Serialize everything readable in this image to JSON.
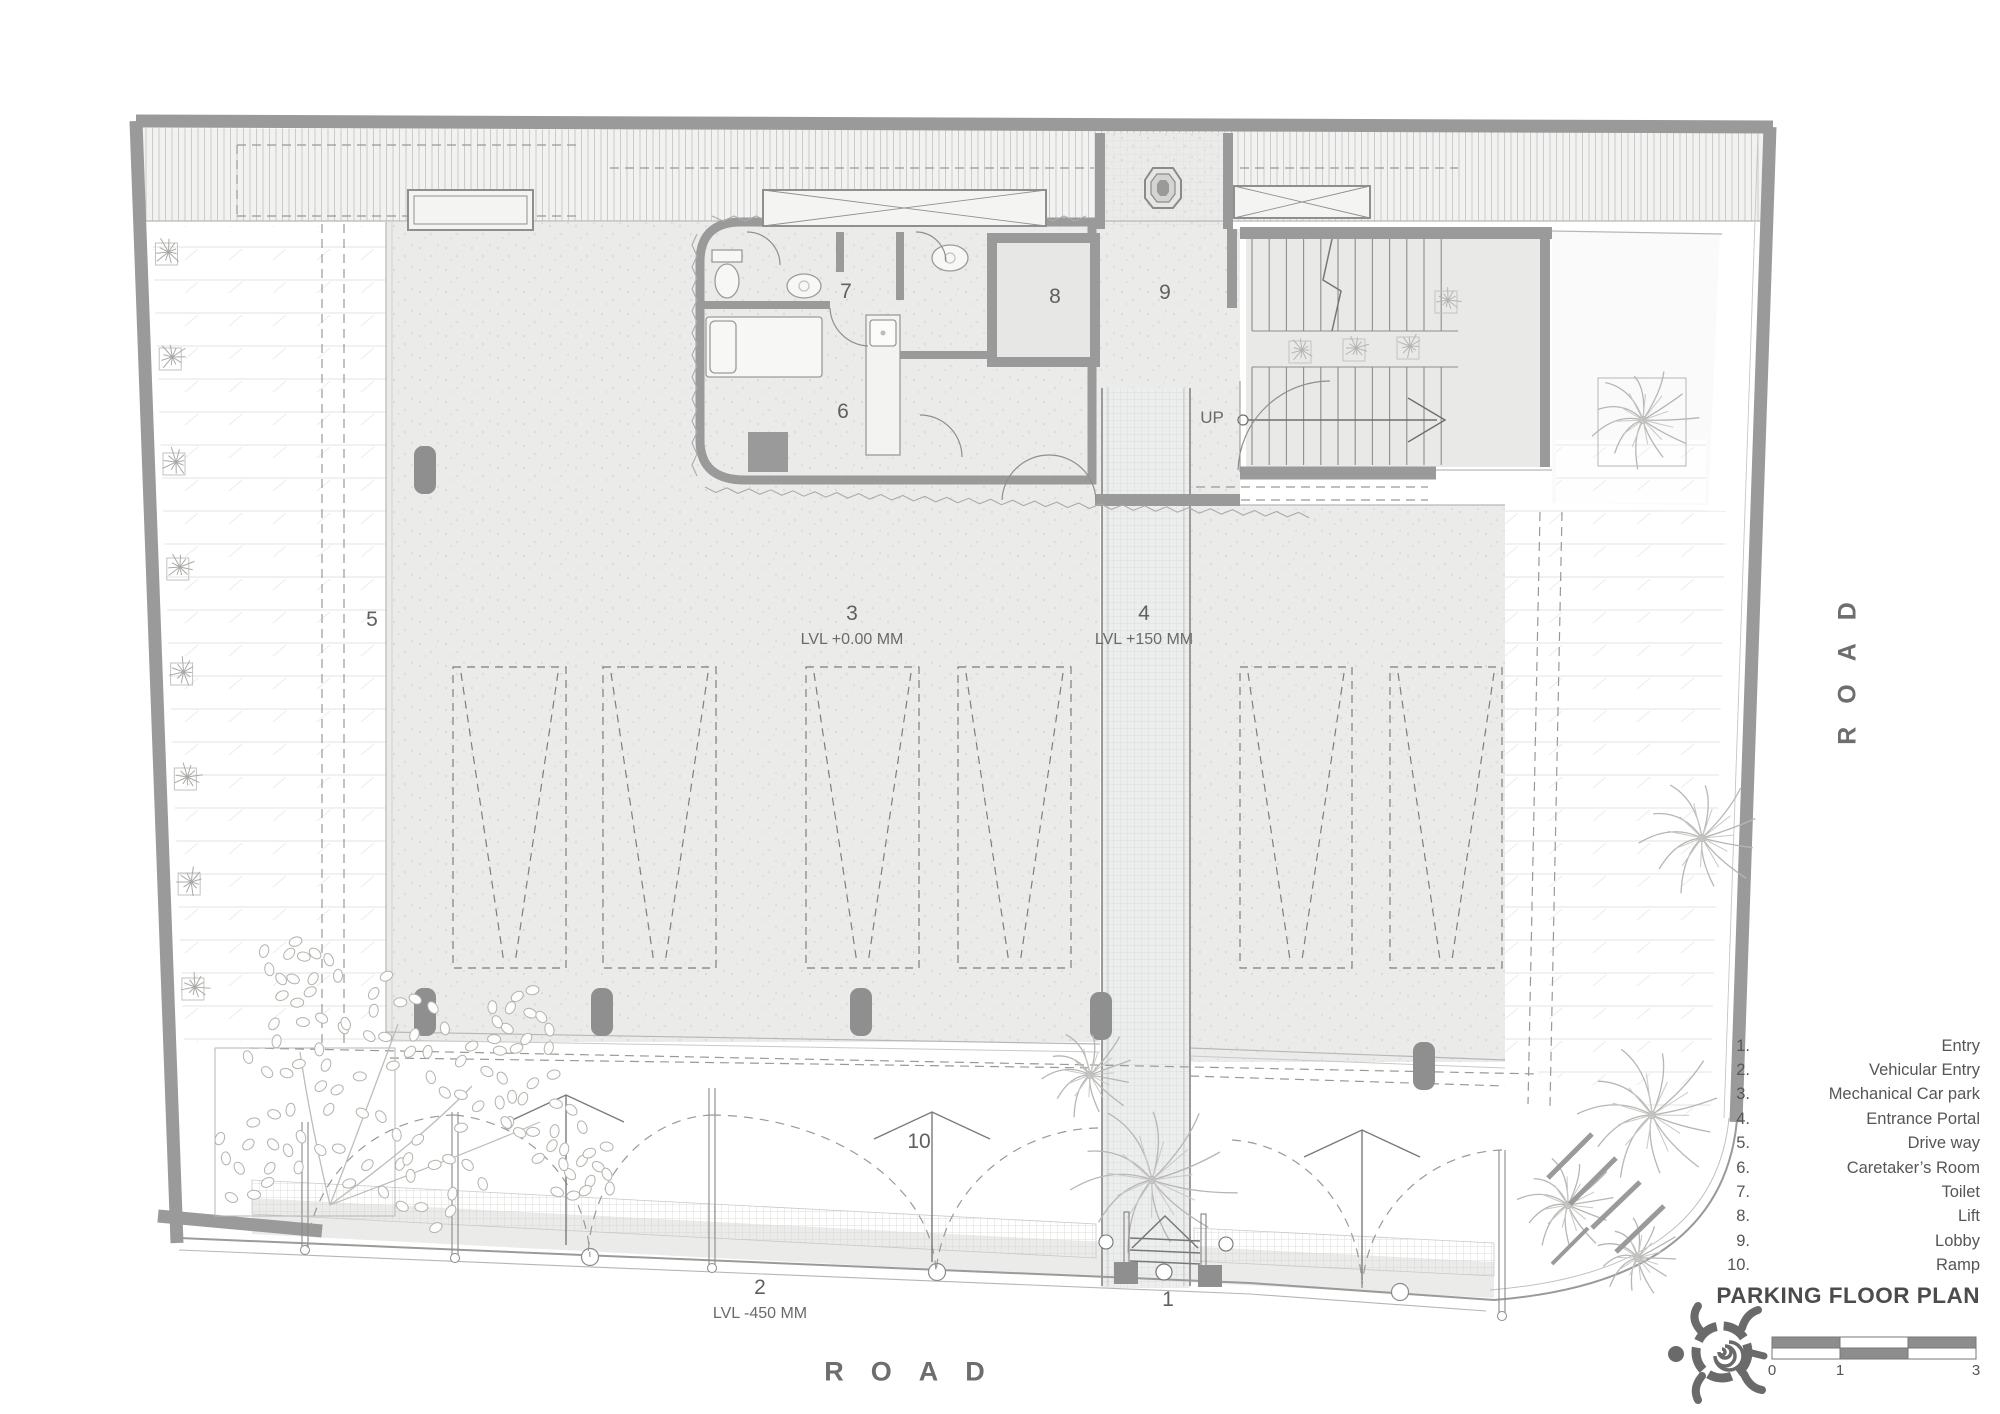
{
  "title": {
    "text": "PARKING FLOOR PLAN"
  },
  "roads": {
    "bottom": "ROAD",
    "right": "ROAD"
  },
  "plan": {
    "numbers": {
      "n1": "1",
      "n2": "2",
      "n3": "3",
      "n4": "4",
      "n5": "5",
      "n6": "6",
      "n7": "7",
      "n8": "8",
      "n9": "9",
      "n10": "10"
    },
    "levels": {
      "l3": "LVL +0.00 MM",
      "l4": "LVL +150 MM",
      "l2": "LVL -450 MM"
    },
    "up": "UP"
  },
  "legend": {
    "items": [
      {
        "n": "1.",
        "t": "Entry"
      },
      {
        "n": "2.",
        "t": "Vehicular Entry"
      },
      {
        "n": "3.",
        "t": "Mechanical Car park"
      },
      {
        "n": "4.",
        "t": "Entrance Portal"
      },
      {
        "n": "5.",
        "t": "Drive way"
      },
      {
        "n": "6.",
        "t": "Caretaker’s Room"
      },
      {
        "n": "7.",
        "t": "Toilet"
      },
      {
        "n": "8.",
        "t": "Lift"
      },
      {
        "n": "9.",
        "t": "Lobby"
      },
      {
        "n": "10.",
        "t": "Ramp"
      }
    ]
  },
  "scalebar": {
    "t0": "0",
    "t1": "1",
    "t3": "3"
  },
  "colors": {
    "wall": "#9a9a9a",
    "text": "#5f5f5f",
    "bar": "#8d8d8d"
  }
}
